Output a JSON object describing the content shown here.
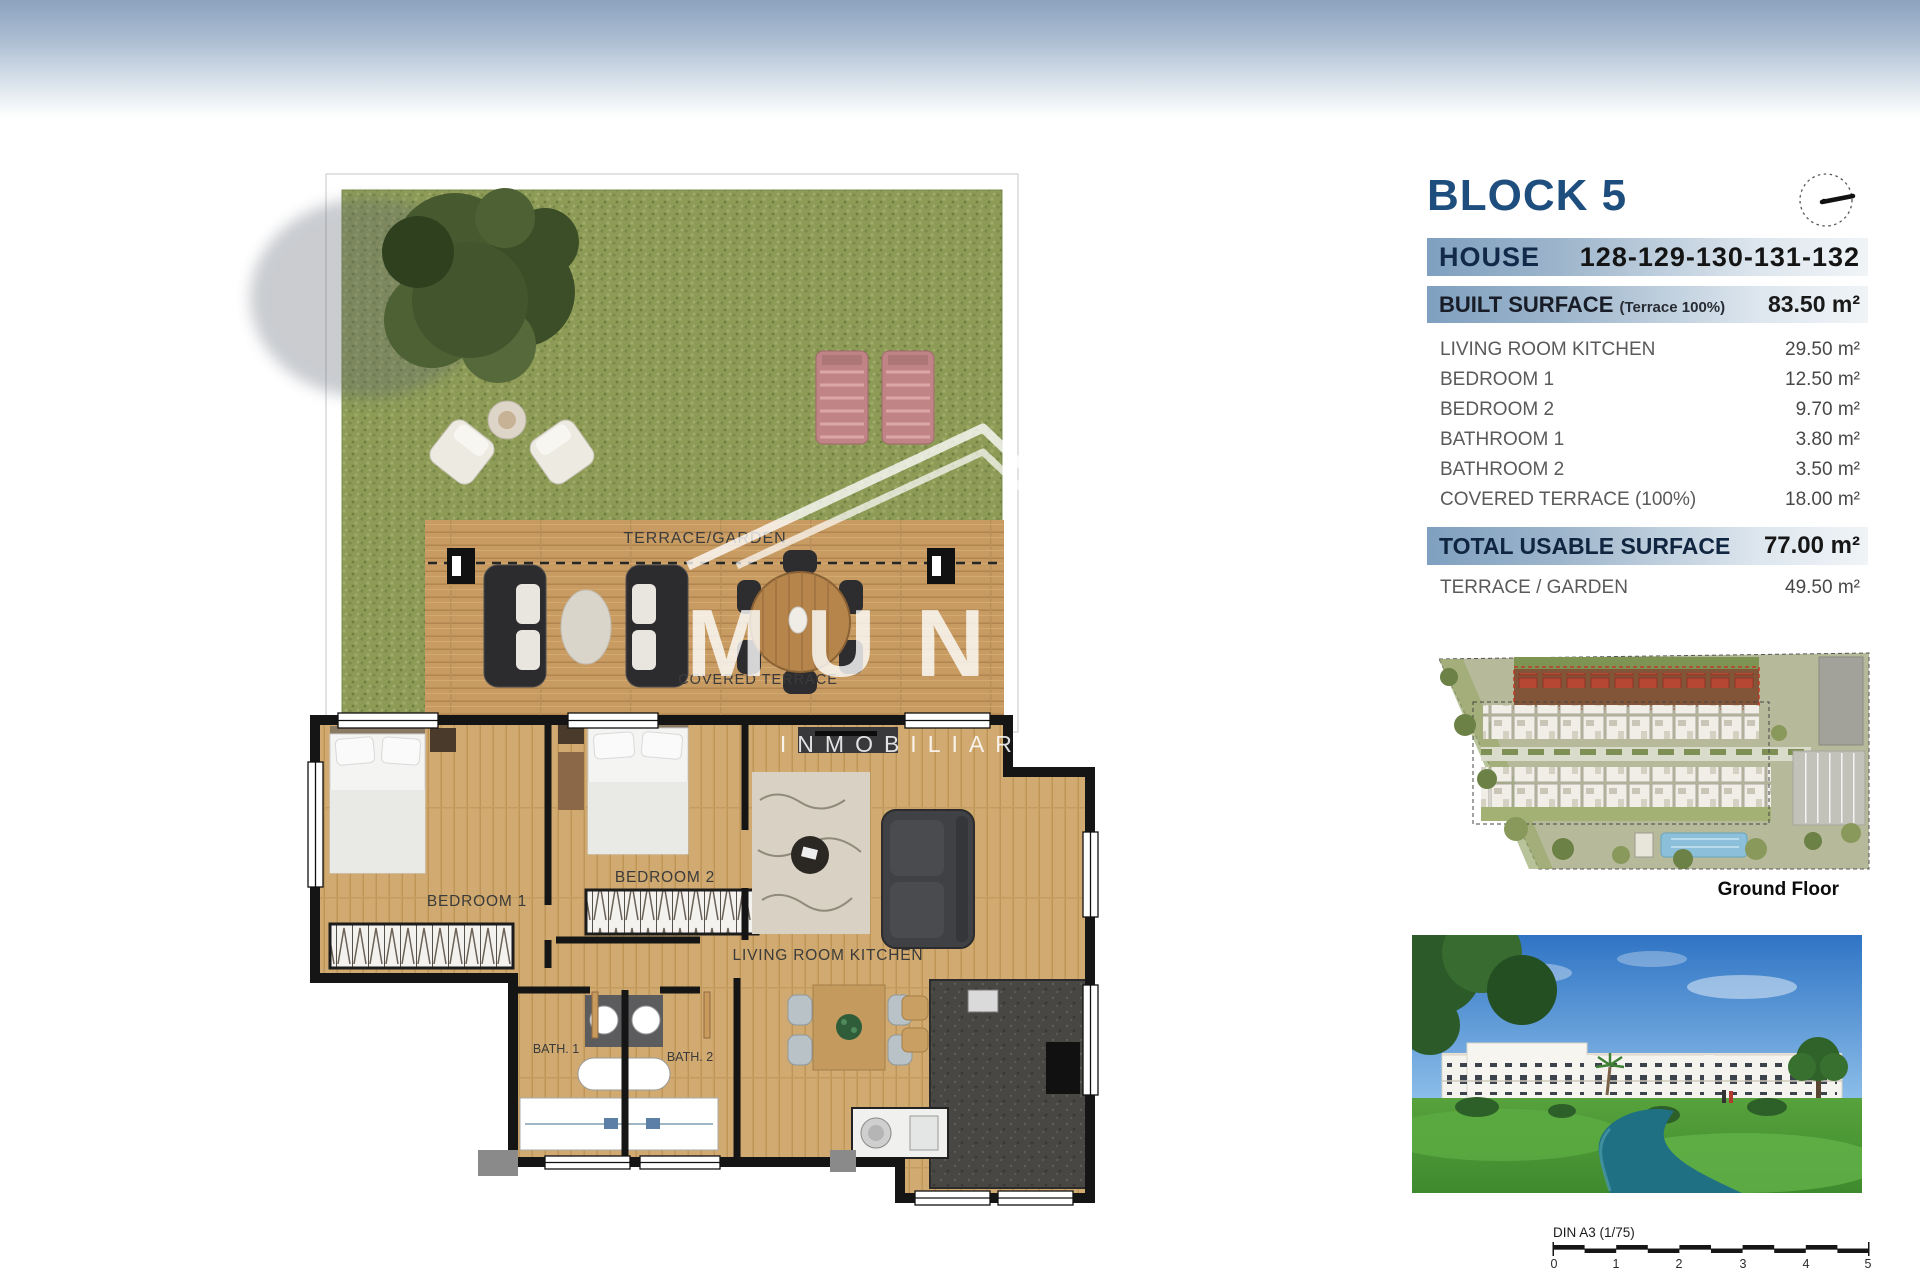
{
  "panel": {
    "block_title": "BLOCK 5",
    "house_label": "HOUSE",
    "house_numbers": "128-129-130-131-132",
    "built": {
      "label": "BUILT SURFACE",
      "note": "(Terrace 100%)",
      "value": "83.50 m²"
    },
    "rows": [
      {
        "label": "LIVING ROOM KITCHEN",
        "value": "29.50 m²"
      },
      {
        "label": "BEDROOM 1",
        "value": "12.50 m²"
      },
      {
        "label": "BEDROOM 2",
        "value": "9.70 m²"
      },
      {
        "label": "BATHROOM 1",
        "value": "3.80 m²"
      },
      {
        "label": "BATHROOM 2",
        "value": "3.50 m²"
      },
      {
        "label": "COVERED TERRACE (100%)",
        "value": "18.00 m²"
      }
    ],
    "total": {
      "label": "TOTAL USABLE SURFACE",
      "value": "77.00 m²"
    },
    "terrace": {
      "label": "TERRACE / GARDEN",
      "value": "49.50 m²"
    },
    "site_caption": "Ground Floor",
    "scale": {
      "label": "DIN A3 (1/75)",
      "ticks": [
        "0",
        "1",
        "2",
        "3",
        "4",
        "5"
      ]
    }
  },
  "floor_plan": {
    "labels": {
      "terrace_garden": "TERRACE/GARDEN",
      "covered_terrace": "COVERED TERRACE",
      "bedroom1": "BEDROOM 1",
      "bedroom2": "BEDROOM 2",
      "living": "LIVING ROOM KITCHEN",
      "bath1": "BATH. 1",
      "bath2": "BATH. 2"
    },
    "watermark": {
      "line1": "MUNF",
      "line2": "INMOBILIARIA I"
    }
  },
  "colors": {
    "accent_navy": "#1d4e7d",
    "band_blue": "#7fa0c0",
    "grass": "#8d9b57",
    "deck_wood": "#c79b62",
    "wall": "#151515",
    "river": "#207083"
  }
}
